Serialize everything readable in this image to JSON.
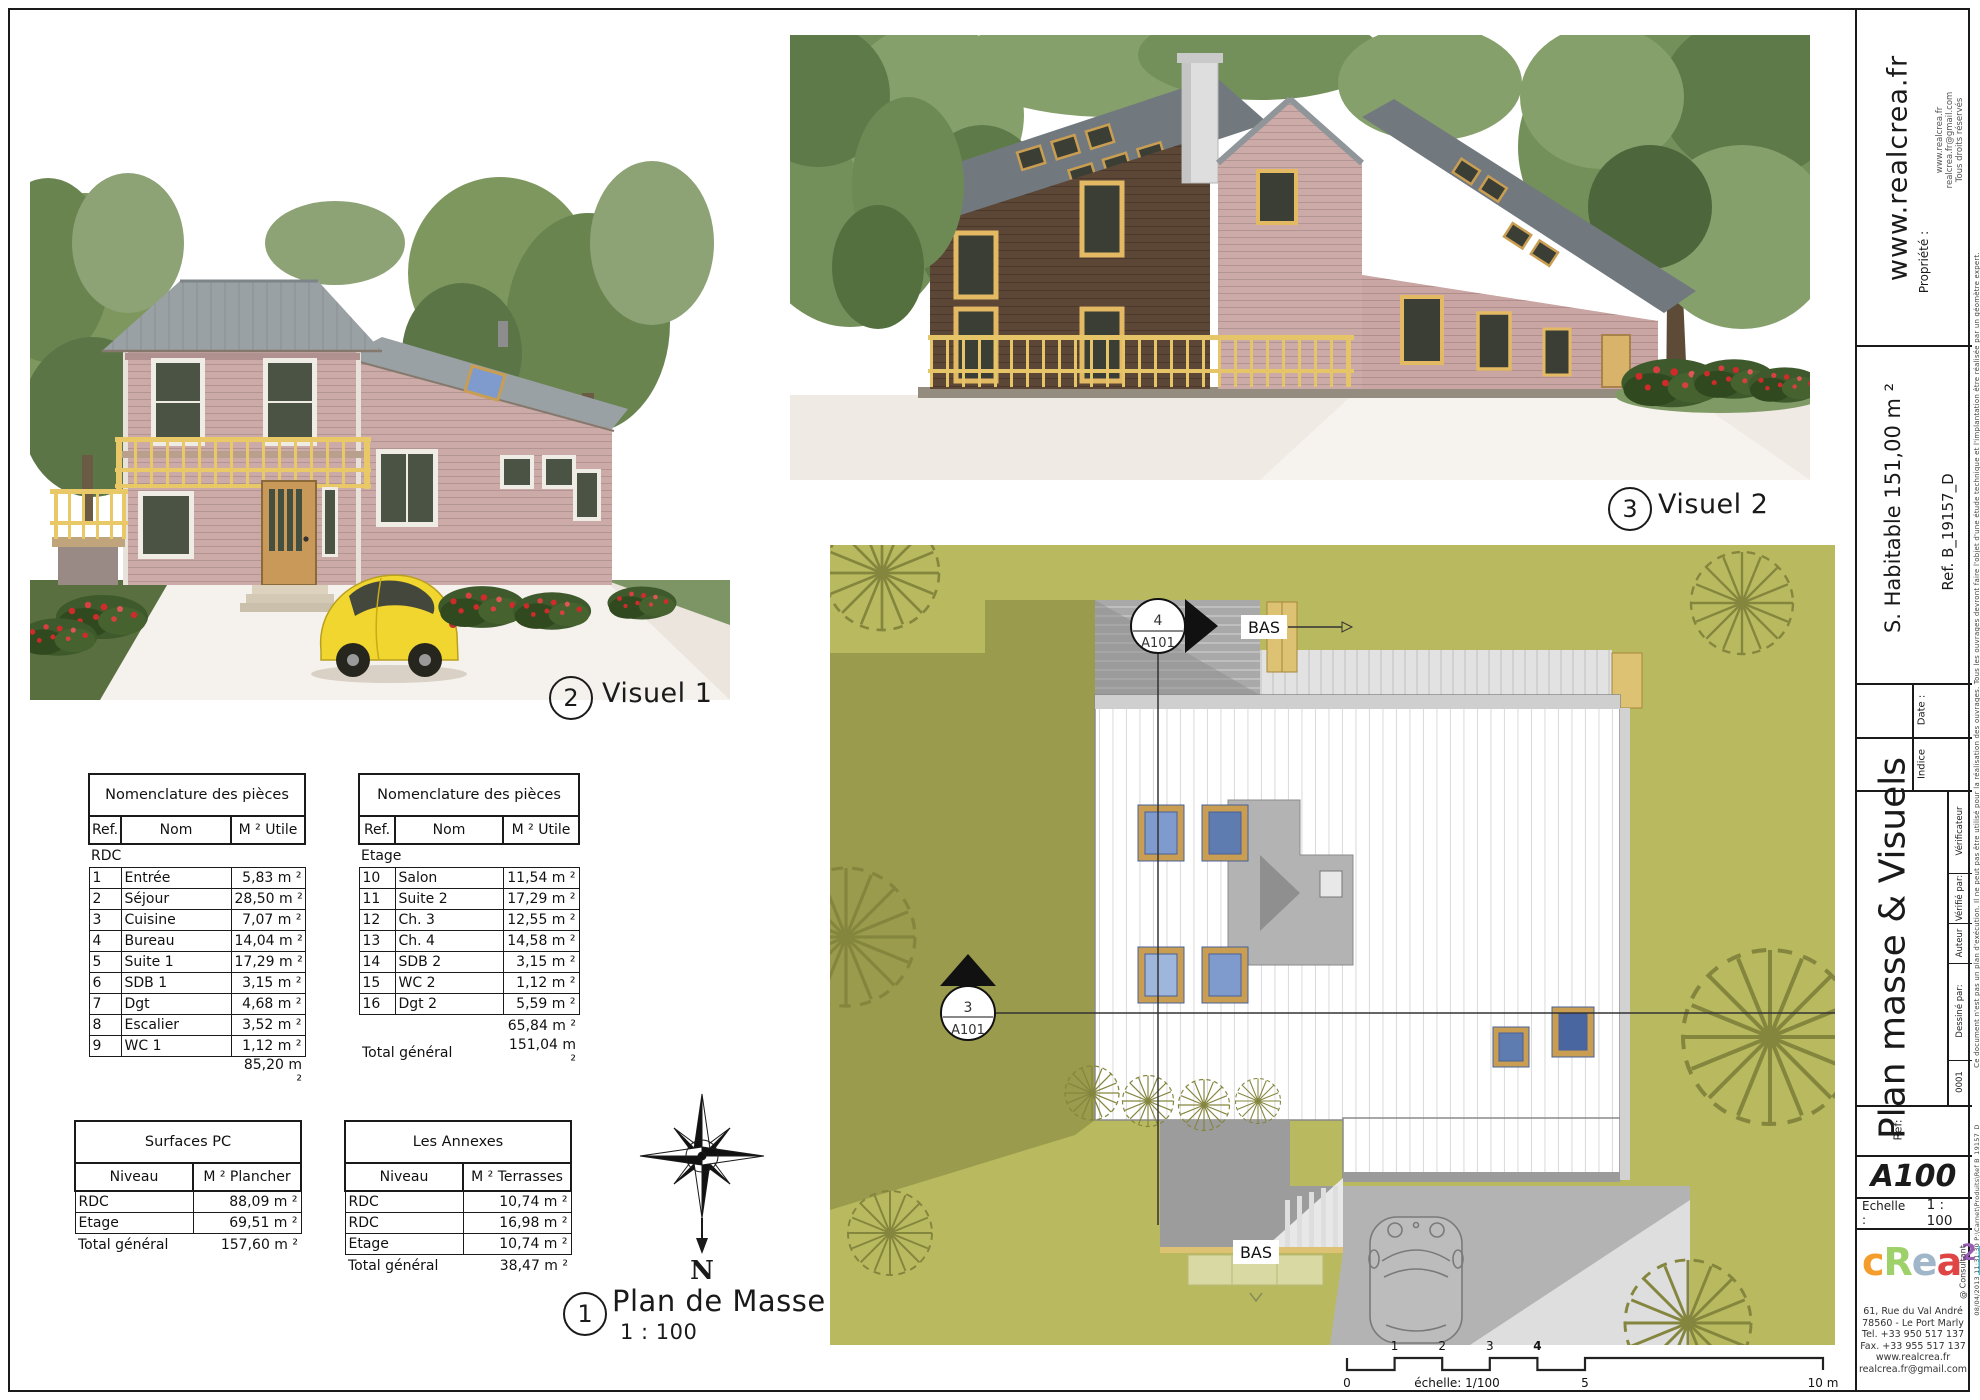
{
  "sheet": {
    "callouts": {
      "visual1": {
        "number": "2",
        "label": "Visuel 1"
      },
      "visual2": {
        "number": "3",
        "label": "Visuel 2"
      },
      "site_plan": {
        "number": "1",
        "label": "Plan de Masse",
        "scale": "1 : 100"
      }
    },
    "north_label": "N",
    "site_plan": {
      "bas_top": "BAS",
      "bas_bottom": "BAS",
      "section_marker_top": {
        "detail": "4",
        "sheet": "A101"
      },
      "section_marker_left": {
        "detail": "3",
        "sheet": "A101"
      },
      "scale_bar": {
        "caption": "échelle: 1/100",
        "ticks_above": [
          "1",
          "2",
          "3",
          "4"
        ],
        "ticks_below": [
          "0",
          "5",
          "10 m"
        ]
      },
      "colors": {
        "grass": "#b9ba5f",
        "shadow": "#9a9b4c",
        "driveway": "#b3b3b3",
        "roof": "#ffffff"
      }
    }
  },
  "tables": {
    "nomenclature_rdc": {
      "title": "Nomenclature des pièces",
      "columns": [
        "Ref.",
        "Nom",
        "M ² Utile"
      ],
      "group": "RDC",
      "rows": [
        [
          "1",
          "Entrée",
          "5,83 m ²"
        ],
        [
          "2",
          "Séjour",
          "28,50 m ²"
        ],
        [
          "3",
          "Cuisine",
          "7,07 m ²"
        ],
        [
          "4",
          "Bureau",
          "14,04 m ²"
        ],
        [
          "5",
          "Suite 1",
          "17,29 m ²"
        ],
        [
          "6",
          "SDB 1",
          "3,15 m ²"
        ],
        [
          "7",
          "Dgt",
          "4,68 m ²"
        ],
        [
          "8",
          "Escalier",
          "3,52 m ²"
        ],
        [
          "9",
          "WC 1",
          "1,12 m ²"
        ]
      ],
      "subtotal": "85,20 m ²"
    },
    "nomenclature_etage": {
      "title": "Nomenclature des pièces",
      "columns": [
        "Ref.",
        "Nom",
        "M ² Utile"
      ],
      "group": "Etage",
      "rows": [
        [
          "10",
          "Salon",
          "11,54 m ²"
        ],
        [
          "11",
          "Suite 2",
          "17,29 m ²"
        ],
        [
          "12",
          "Ch. 3",
          "12,55 m ²"
        ],
        [
          "13",
          "Ch. 4",
          "14,58 m ²"
        ],
        [
          "14",
          "SDB 2",
          "3,15 m ²"
        ],
        [
          "15",
          "WC 2",
          "1,12 m ²"
        ],
        [
          "16",
          "Dgt 2",
          "5,59 m ²"
        ]
      ],
      "subtotal": "65,84 m ²",
      "total_label": "Total général",
      "total": "151,04 m ²"
    },
    "surfaces_pc": {
      "title": "Surfaces PC",
      "columns": [
        "Niveau",
        "M ² Plancher"
      ],
      "rows": [
        [
          "RDC",
          "88,09 m ²"
        ],
        [
          "Etage",
          "69,51 m ²"
        ]
      ],
      "total_label": "Total général",
      "total": "157,60 m ²"
    },
    "annexes": {
      "title": "Les Annexes",
      "columns": [
        "Niveau",
        "M ² Terrasses"
      ],
      "rows": [
        [
          "RDC",
          "10,74 m ²"
        ],
        [
          "RDC",
          "16,98 m ²"
        ],
        [
          "Etage",
          "10,74 m ²"
        ]
      ],
      "total_label": "Total général",
      "total": "38,47 m ²"
    }
  },
  "titleblock": {
    "propriete_label": "Propriété :",
    "website": "www.realcrea.fr",
    "contact": [
      "www.realcrea.fr",
      "realcrea.fr@gmail.com",
      "Tous droits réservés"
    ],
    "habitable": "S. Habitable 151,00 m ²",
    "ref": "Ref. B_19157_D",
    "date_label": "Date :",
    "indice_label": "Indice",
    "sheet_title": "Plan masse & Visuels",
    "drawn_by_label": "Dessiné par:",
    "drawn_by": "Auteur",
    "checked_by_label": "Vérifié par:",
    "checked_by": "Vérificateur",
    "revision": "0001",
    "ref_label": "Ref:",
    "sheet_number": "A100",
    "scale_label": "Echelle :",
    "scale_value": "1 : 100",
    "logo": {
      "letters": [
        {
          "t": "c",
          "c": "#f49c2c"
        },
        {
          "t": "R",
          "c": "#9ed16a"
        },
        {
          "t": "e",
          "c": "#9fb7c8"
        },
        {
          "t": "a",
          "c": "#e04545"
        },
        {
          "t": "2",
          "c": "#9a5bb5"
        },
        {
          "t": "l",
          "c": "#35c4d7"
        }
      ],
      "consultant": "@ Consultant"
    },
    "address": [
      "61, Rue du Val André",
      "78560 - Le Port Marly",
      "Tel. +33 950 517 137",
      "Fax. +33 955 517 137",
      "www.realcrea.fr",
      "realcrea.fr@gmail.com"
    ],
    "disclaimer": "Ce document n'est pas un plan d'exécution. Il ne peut pas être utilisé pour la réalisation des ouvrages. Tous les ouvrages devront faire l'objet d'une étude technique et l'implantation être réalisée par un géomètre expert.",
    "file_stamp": "08/04/2013 11:31:30 P:\\Carnet\\Produits\\Ref B_19157_D"
  }
}
